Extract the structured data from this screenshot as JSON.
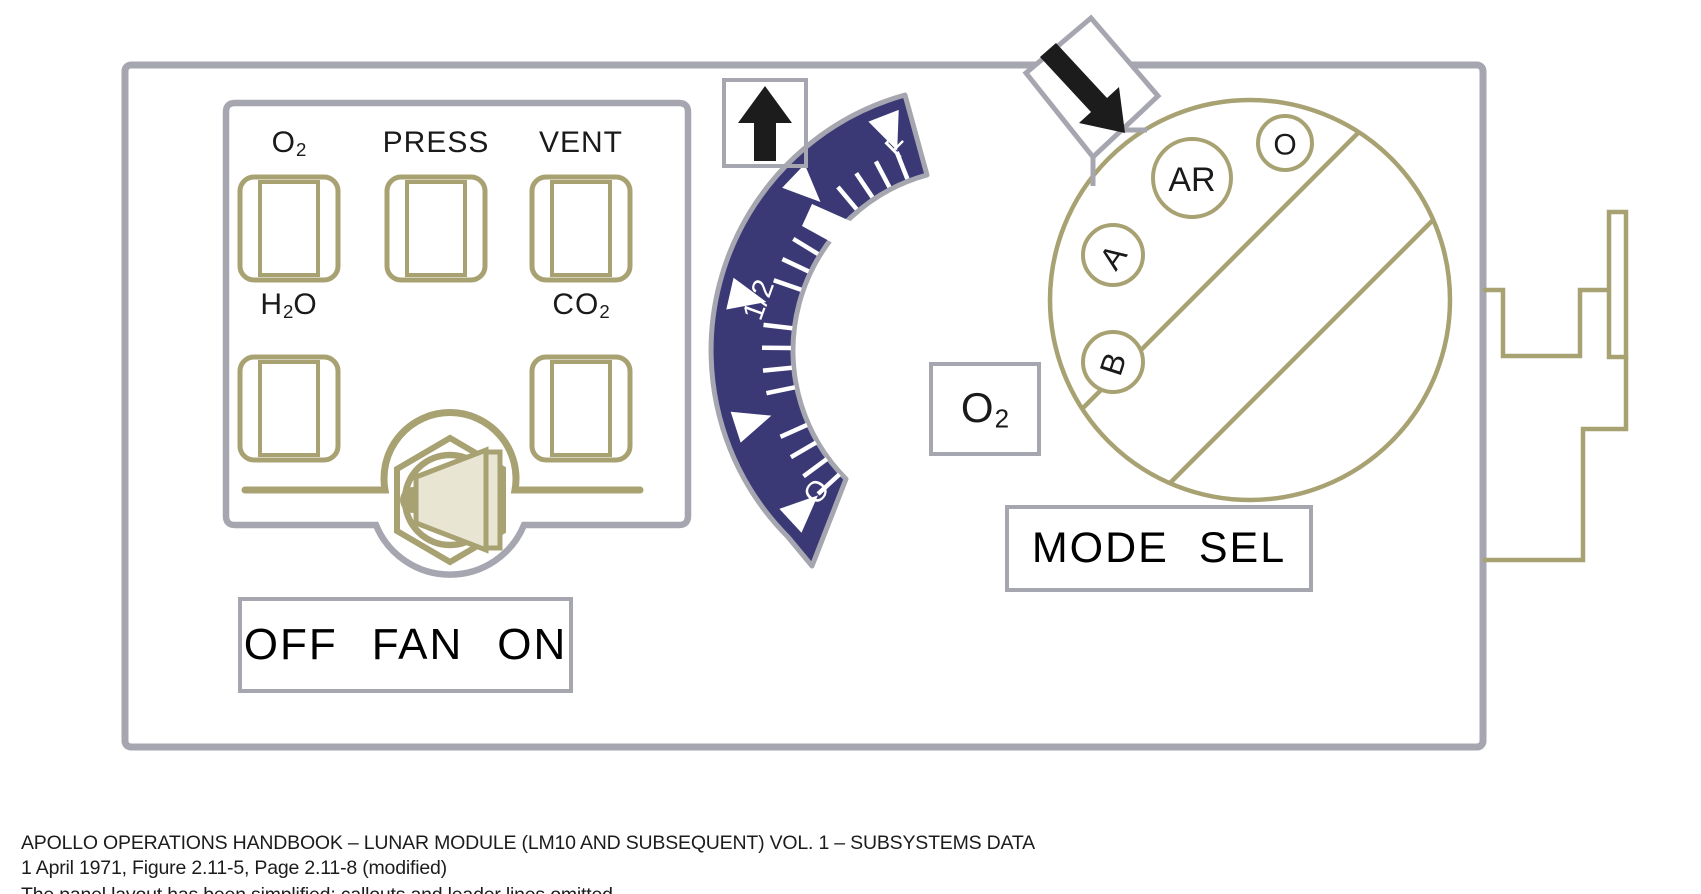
{
  "figure_title": "Apollo LM ECS control panel schematic (modified handbook figure)",
  "colors": {
    "panel_gray": "#a6a6b0",
    "olive": "#a8a273",
    "navy": "#3a3976",
    "ink": "#1a1a1a",
    "beige": "#e8e5d3",
    "white": "#ffffff"
  },
  "indicator_panel": {
    "windows": {
      "o2": {
        "base": "O",
        "sub": "2"
      },
      "press": {
        "text": "PRESS"
      },
      "vent": {
        "text": "VENT"
      },
      "h2o": {
        "p1": "H",
        "sub": "2",
        "p2": "O"
      },
      "co2": {
        "base": "CO",
        "sub": "2"
      }
    },
    "fan_switch": {
      "off": "OFF",
      "fan": "FAN",
      "on": "ON"
    }
  },
  "gauge": {
    "scale_labels": {
      "full": "F",
      "half": "1/2",
      "empty": "O"
    },
    "unit_label": {
      "base": "O",
      "sub": "2"
    },
    "needle_fraction": 0.73,
    "major_fractions": [
      0,
      0.25,
      0.5,
      0.75,
      1
    ],
    "minor_step": 0.05,
    "geom": {
      "cx": 975,
      "cy": 350,
      "r_outer": 265,
      "r_inner": 182,
      "angle_start": 131.3,
      "angle_sweep": 123.3,
      "tick_r1": 184,
      "tick_r2": 213,
      "tri_apex_r": 214,
      "tri_base_r": 252,
      "tri_half_df": 0.03
    }
  },
  "mode_selector": {
    "label_box": {
      "word1": "MODE",
      "word2": "SEL"
    },
    "positions": {
      "o": "O",
      "ar": "AR",
      "a": "A",
      "b": "B"
    }
  },
  "annotations": {
    "up_arrow_icon": "up-arrow",
    "diagonal_arrow_icon": "down-right-arrow"
  },
  "caption": {
    "line1": "APOLLO OPERATIONS HANDBOOK – LUNAR MODULE (LM10 AND SUBSEQUENT) VOL. 1 – SUBSYSTEMS DATA",
    "line2": "1 April 1971, Figure 2.11-5, Page 2.11-8 (modified)",
    "line3_clipped": "The panel layout has been simplified; callouts and leader lines omitted"
  }
}
